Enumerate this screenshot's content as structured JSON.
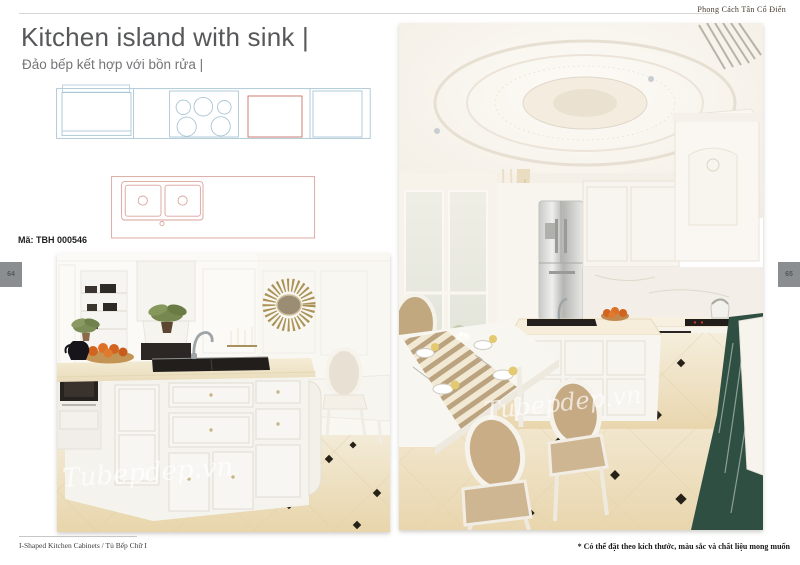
{
  "page": {
    "style_label": "Phong Cách Tân Cổ Điển",
    "title": "Kitchen island with sink |",
    "subtitle": "Đảo bếp kết hợp với bồn rửa |",
    "product_code": "Mã: TBH 000546",
    "page_number_left": "64",
    "page_number_right": "65",
    "footer_left": "I-Shaped Kitchen Cabinets / Tủ Bếp Chữ I",
    "footer_right": "* Có thể đặt theo kích thước, màu sắc và chất liệu mong muốn",
    "watermark": "Tubepdep.vn",
    "colors": {
      "drawing_blue": "#a9c6d4",
      "drawing_red": "#d9a29c",
      "oven_red": "#c96f66",
      "tab_gray": "#8b8e90",
      "title_gray": "#57585a",
      "subtitle_gray": "#737477",
      "header_brown": "#45382a",
      "floor_cream": "#ead8b4",
      "marble_green": "#2f4f42"
    }
  }
}
